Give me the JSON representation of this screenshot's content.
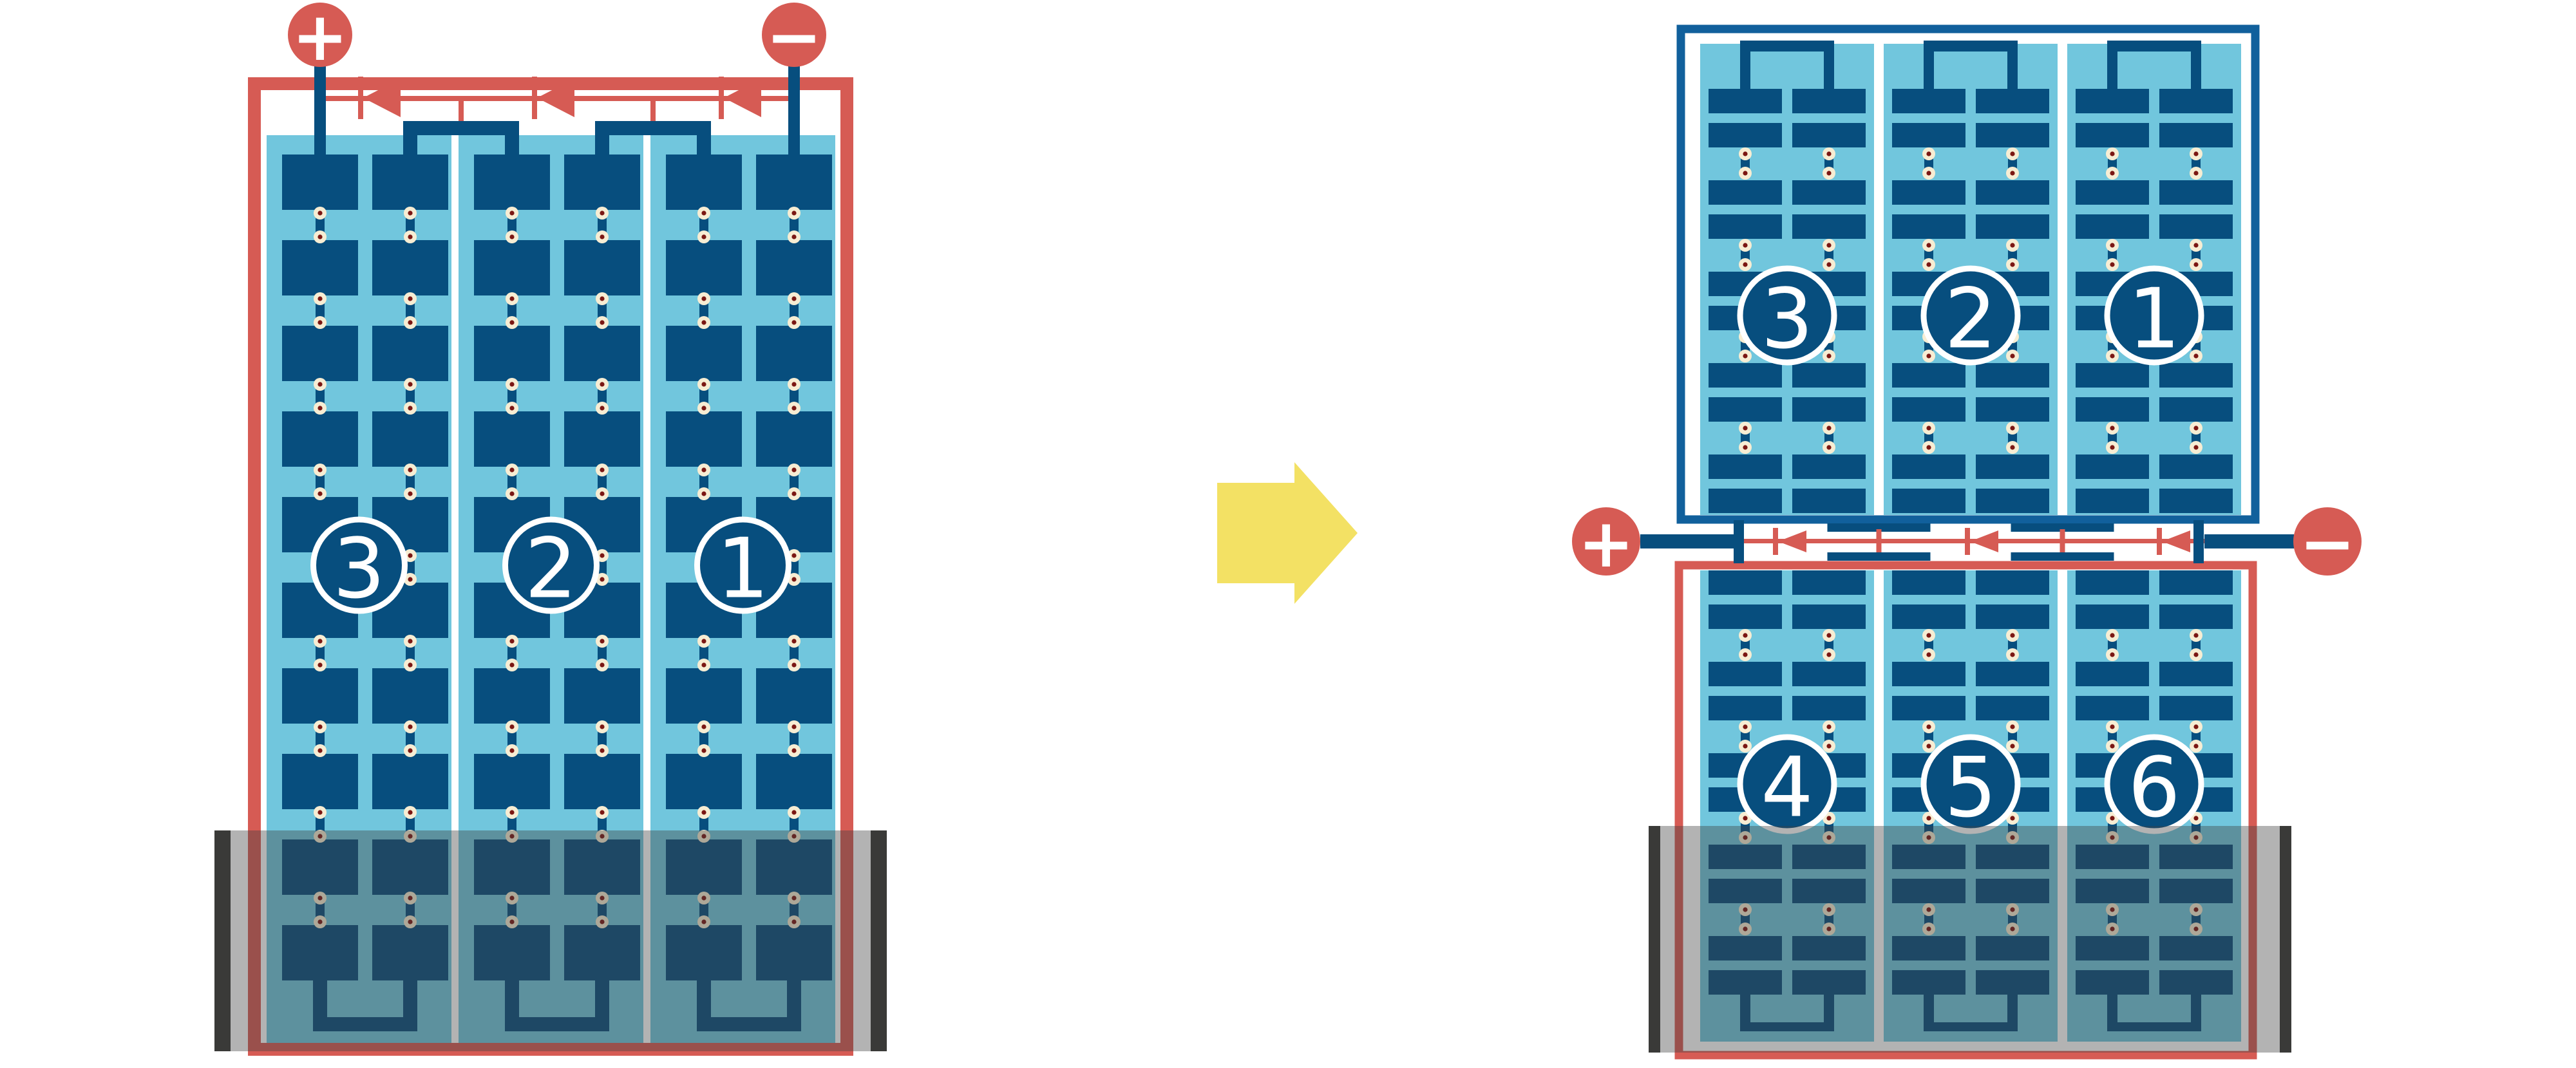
{
  "left_diagram": {
    "positive_terminal": "+",
    "negative_terminal": "−",
    "modules": [
      {
        "label": "3"
      },
      {
        "label": "2"
      },
      {
        "label": "1"
      }
    ]
  },
  "right_diagram": {
    "positive_terminal": "+",
    "negative_terminal": "−",
    "top_modules": [
      {
        "label": "3"
      },
      {
        "label": "2"
      },
      {
        "label": "1"
      }
    ],
    "bottom_modules": [
      {
        "label": "4"
      },
      {
        "label": "5"
      },
      {
        "label": "6"
      }
    ]
  },
  "transform_arrow": {
    "icon": "arrow-right-icon"
  },
  "colors": {
    "red": "#d65b54",
    "navy": "#074e7e",
    "frame_blue": "#11609c",
    "light_blue": "#71c6dd",
    "cream": "#f7edd3",
    "maroon": "#7b1713",
    "yellow": "#f3e164",
    "tank_bar": "#3a3a38",
    "tank_overlay": "rgba(65,65,65,0.40)",
    "white": "#ffffff"
  }
}
